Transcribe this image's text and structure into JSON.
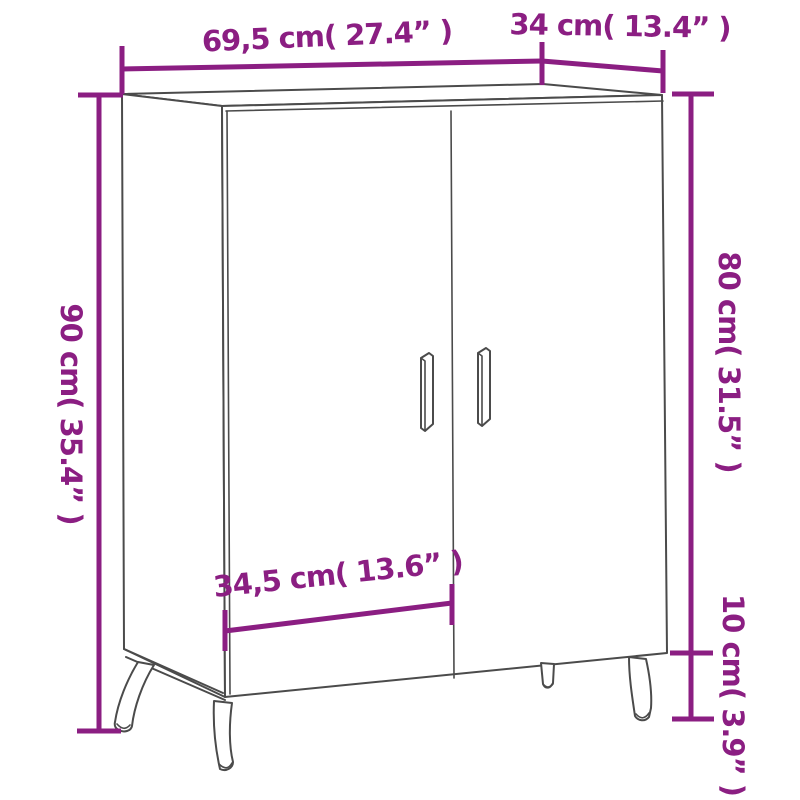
{
  "diagram": {
    "kind": "furniture-dimension-drawing",
    "dimensions": {
      "width": "69,5 cm( 27.4” )",
      "depth": "34 cm( 13.4” )",
      "height": "90 cm( 35.4” )",
      "body_height": "80 cm( 31.5” )",
      "leg_height": "10 cm( 3.9” )",
      "door_width": "34,5 cm( 13.6” )"
    }
  },
  "colors": {
    "dimension_accent": "#8B1E82",
    "line_art": "#4B4B4B",
    "background": "#FFFFFF"
  }
}
